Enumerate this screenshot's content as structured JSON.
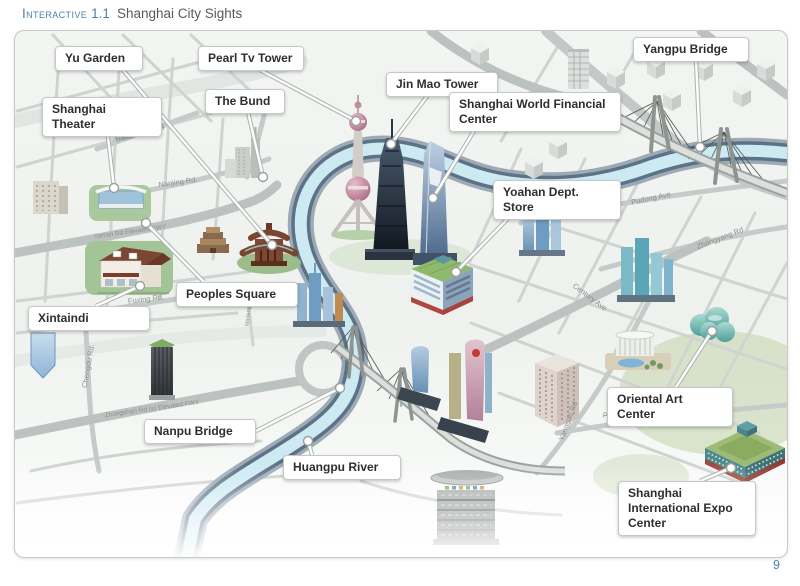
{
  "header": {
    "kicker": "Interactive",
    "figure_number": "1.1",
    "title": "Shanghai City Sights"
  },
  "page_number": "9",
  "colors": {
    "accent_blue": "#4f80ab",
    "river_water": "#cdeaf3",
    "river_bank": "#5d7287",
    "road_gray": "#bcc2bf",
    "callout_text": "#2e2e2e"
  },
  "map": {
    "callouts": [
      {
        "name": "yu-garden",
        "label": "Yu Garden",
        "box": [
          55,
          46,
          88
        ],
        "from": [
          122,
          69
        ],
        "end": [
          272,
          245
        ]
      },
      {
        "name": "pearl-tv-tower",
        "label": "Pearl Tv Tower",
        "box": [
          198,
          46,
          106
        ],
        "from": [
          260,
          70
        ],
        "end": [
          356,
          121
        ]
      },
      {
        "name": "shanghai-theater",
        "label": "Shanghai Theater",
        "box": [
          42,
          97,
          120
        ],
        "from": [
          106,
          120
        ],
        "end": [
          114,
          188
        ]
      },
      {
        "name": "the-bund",
        "label": "The Bund",
        "box": [
          205,
          89,
          80
        ],
        "from": [
          248,
          112
        ],
        "end": [
          263,
          177
        ]
      },
      {
        "name": "jin-mao-tower",
        "label": "Jin Mao Tower",
        "box": [
          386,
          72,
          112
        ],
        "from": [
          428,
          95
        ],
        "end": [
          391,
          144
        ]
      },
      {
        "name": "shanghai-world-financial-center",
        "label": "Shanghai World Financial Center",
        "box": [
          449,
          92,
          172
        ],
        "from": [
          474,
          131
        ],
        "end": [
          433,
          198
        ]
      },
      {
        "name": "yangpu-bridge",
        "label": "Yangpu Bridge",
        "box": [
          633,
          37,
          116
        ],
        "from": [
          696,
          60
        ],
        "end": [
          700,
          147
        ]
      },
      {
        "name": "yoahan-dept-store",
        "label": "Yoahan Dept. Store",
        "box": [
          493,
          180,
          128
        ],
        "from": [
          522,
          204
        ],
        "end": [
          456,
          272
        ]
      },
      {
        "name": "peoples-square",
        "label": "Peoples Square",
        "box": [
          176,
          282,
          122
        ],
        "from": [
          204,
          282
        ],
        "end": [
          146,
          223
        ]
      },
      {
        "name": "xintaindi",
        "label": "Xintaindi",
        "box": [
          28,
          306,
          122
        ],
        "from": [
          96,
          306
        ],
        "end": [
          140,
          286
        ]
      },
      {
        "name": "oriental-art-center",
        "label": "Oriental Art Center",
        "box": [
          607,
          387,
          126
        ],
        "from": [
          676,
          387
        ],
        "end": [
          712,
          331
        ]
      },
      {
        "name": "nanpu-bridge",
        "label": "Nanpu Bridge",
        "box": [
          144,
          419,
          112
        ],
        "from": [
          256,
          431
        ],
        "end": [
          340,
          388
        ]
      },
      {
        "name": "huangpu-river",
        "label": "Huangpu River",
        "box": [
          283,
          455,
          118
        ],
        "from": [
          312,
          455
        ],
        "end": [
          308,
          441
        ]
      },
      {
        "name": "shanghai-international-expo-center",
        "label": "Shanghai International Expo Center",
        "box": [
          618,
          481,
          138
        ],
        "from": [
          700,
          481
        ],
        "end": [
          731,
          468
        ]
      }
    ],
    "road_labels": [
      {
        "name": "baoshan-rd-s",
        "text": "Baoshan Rd. S",
        "x": 140,
        "y": 133,
        "rot": -15
      },
      {
        "name": "nanjing-rd",
        "text": "Nanjing Rd.",
        "x": 178,
        "y": 182,
        "rot": -8
      },
      {
        "name": "yanan-rd-elevated-fwy",
        "text": "Yan'an Rd Elevated FWY",
        "x": 130,
        "y": 232,
        "rot": -8,
        "size": 6.5
      },
      {
        "name": "fuxing-rd",
        "text": "Fuxing Rd.",
        "x": 146,
        "y": 299,
        "rot": -7
      },
      {
        "name": "chengdu-rd",
        "text": "Chengdu Rd.",
        "x": 88,
        "y": 366,
        "rot": -80
      },
      {
        "name": "zhongshan-rd-elevated-fwy",
        "text": "Zhongshan Rd (s) Elevated FWY",
        "x": 152,
        "y": 409,
        "rot": -8,
        "size": 6.5
      },
      {
        "name": "madang-rd",
        "text": "Madang Rd",
        "x": 249,
        "y": 312,
        "rot": -85,
        "size": 5.5
      },
      {
        "name": "pudong-ave",
        "text": "Pudong Ave",
        "x": 651,
        "y": 198,
        "rot": -12
      },
      {
        "name": "zhangyang-rd",
        "text": "Zhangyang Rd",
        "x": 720,
        "y": 238,
        "rot": -21
      },
      {
        "name": "century-ave",
        "text": "Century Ave",
        "x": 590,
        "y": 297,
        "rot": 37
      },
      {
        "name": "yanggao-rd",
        "text": "Yanggao Rd",
        "x": 568,
        "y": 421,
        "rot": -70
      },
      {
        "name": "pujian-rd",
        "text": "Pujian Rd.",
        "x": 620,
        "y": 417,
        "rot": 7
      }
    ]
  }
}
